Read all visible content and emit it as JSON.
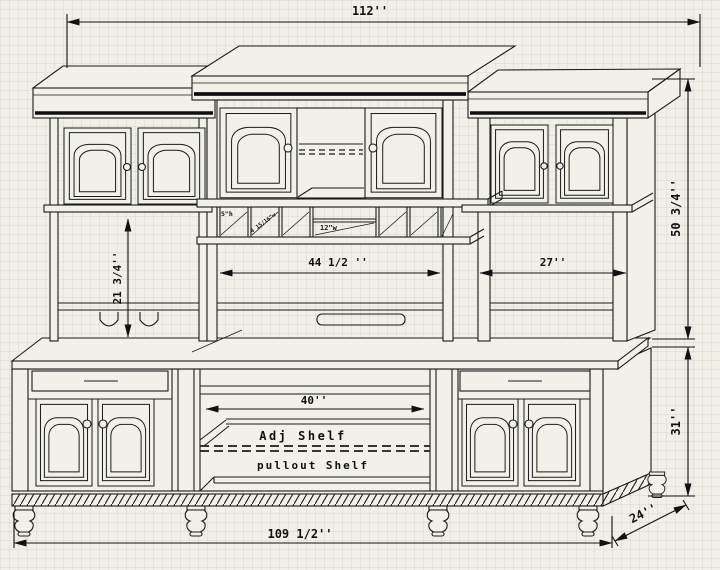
{
  "title": "hutch-cabinet-technical-drawing",
  "colors": {
    "background": "#f0efe8",
    "paper": "#f1f0e9",
    "line": "#1b1b1b"
  },
  "dimensions": {
    "overall_width": "112''",
    "hutch_height": "50 3/4''",
    "base_height": "31''",
    "base_width": "109 1/2''",
    "base_depth": "24''",
    "left_opening_height": "21 3/4''",
    "center_opening_width": "44 1/2 ''",
    "right_opening_width": "27''",
    "base_center_opening_width": "40''"
  },
  "wine_rack": {
    "slot_height": "5\"h",
    "slot_width": "4 15/16\"w",
    "center_slot_width": "12\"w"
  },
  "shelf_labels": {
    "adjustable": "Adj Shelf",
    "pullout": "pullout Shelf"
  }
}
